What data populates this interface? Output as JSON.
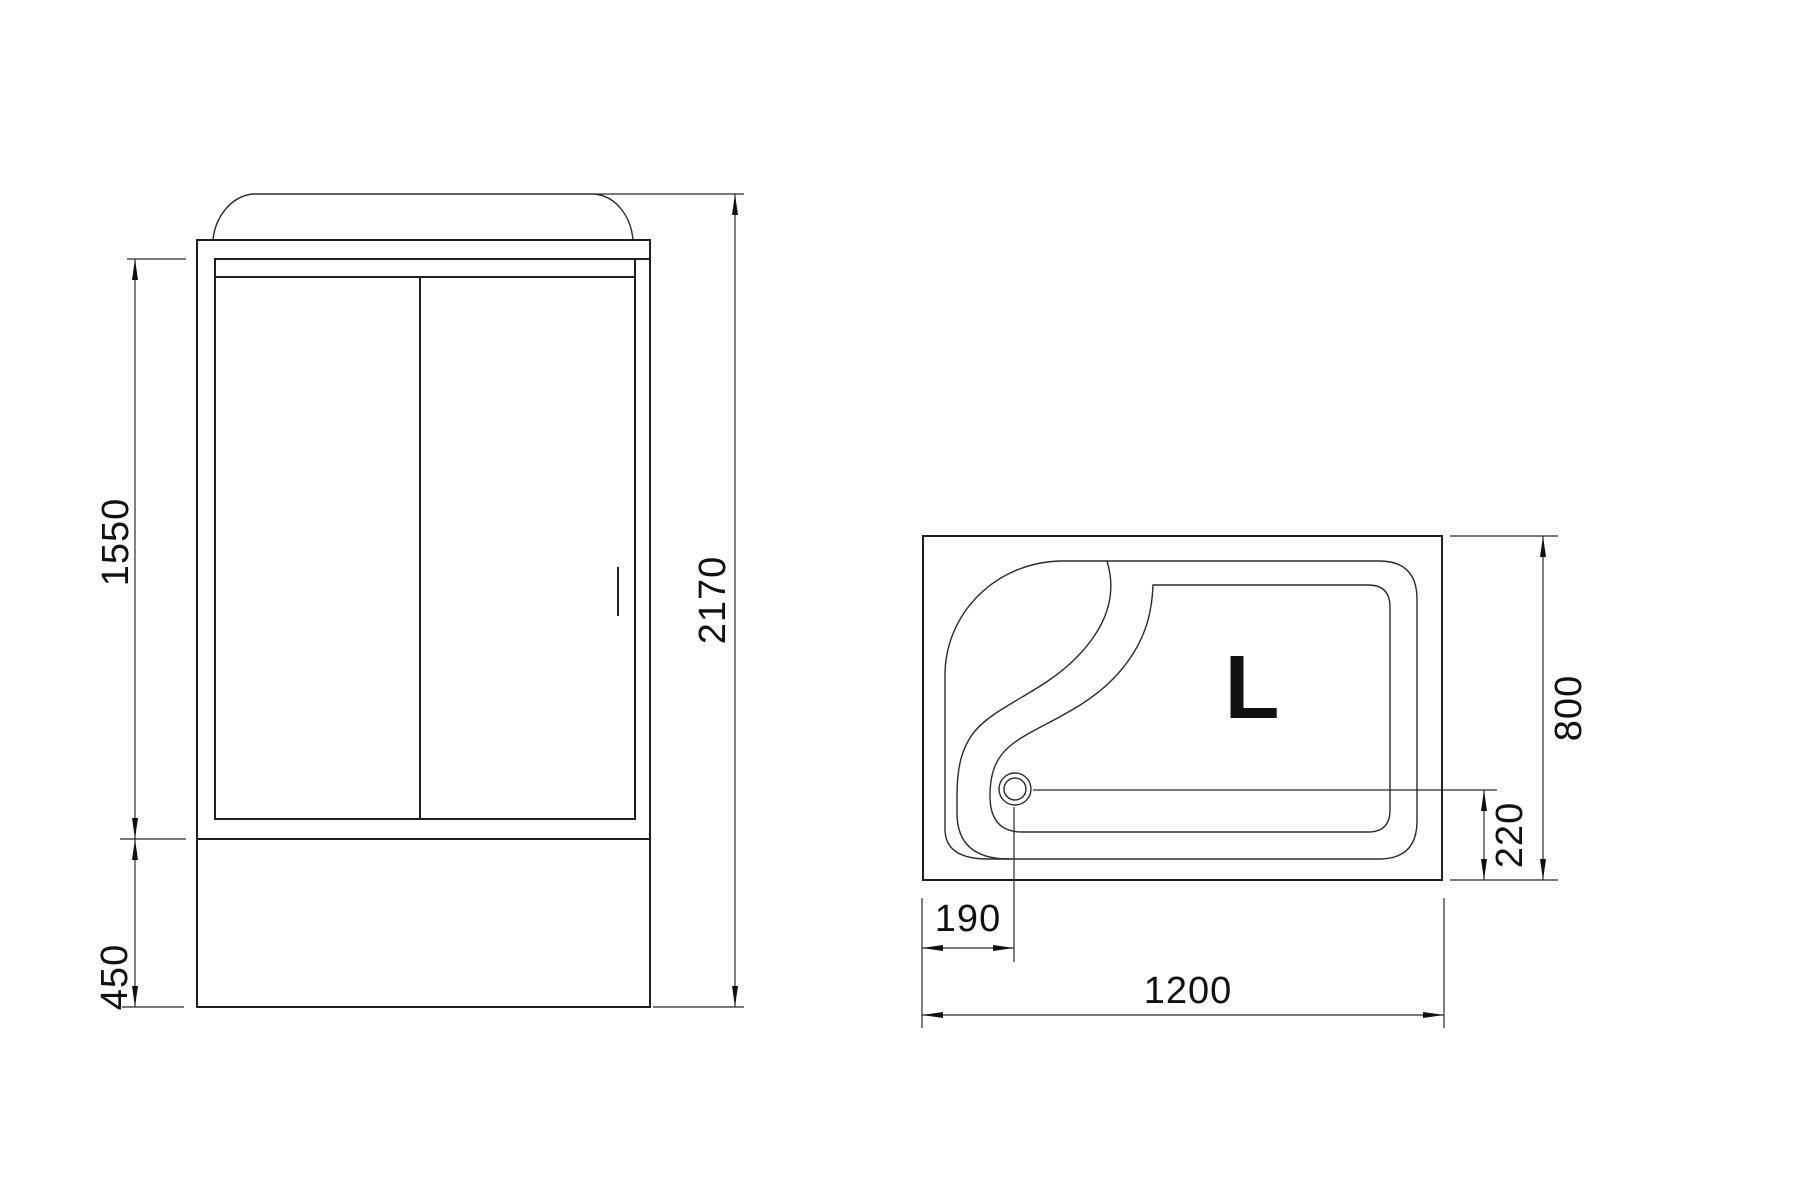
{
  "front_view": {
    "dims": {
      "door_height": {
        "label": "1550"
      },
      "base_height": {
        "label": "450"
      },
      "total_height": {
        "label": "2170"
      }
    }
  },
  "top_view": {
    "orientation_label": "L",
    "dims": {
      "drain_from_left": {
        "label": "190"
      },
      "total_width": {
        "label": "1200"
      },
      "total_depth": {
        "label": "800"
      },
      "drain_from_bottom": {
        "label": "220"
      }
    }
  },
  "colors": {
    "background": "#ffffff",
    "line": "#1f1f1f",
    "detail_line": "#2b2b2b",
    "dim_line": "#2b2b2b",
    "text": "#111111"
  }
}
